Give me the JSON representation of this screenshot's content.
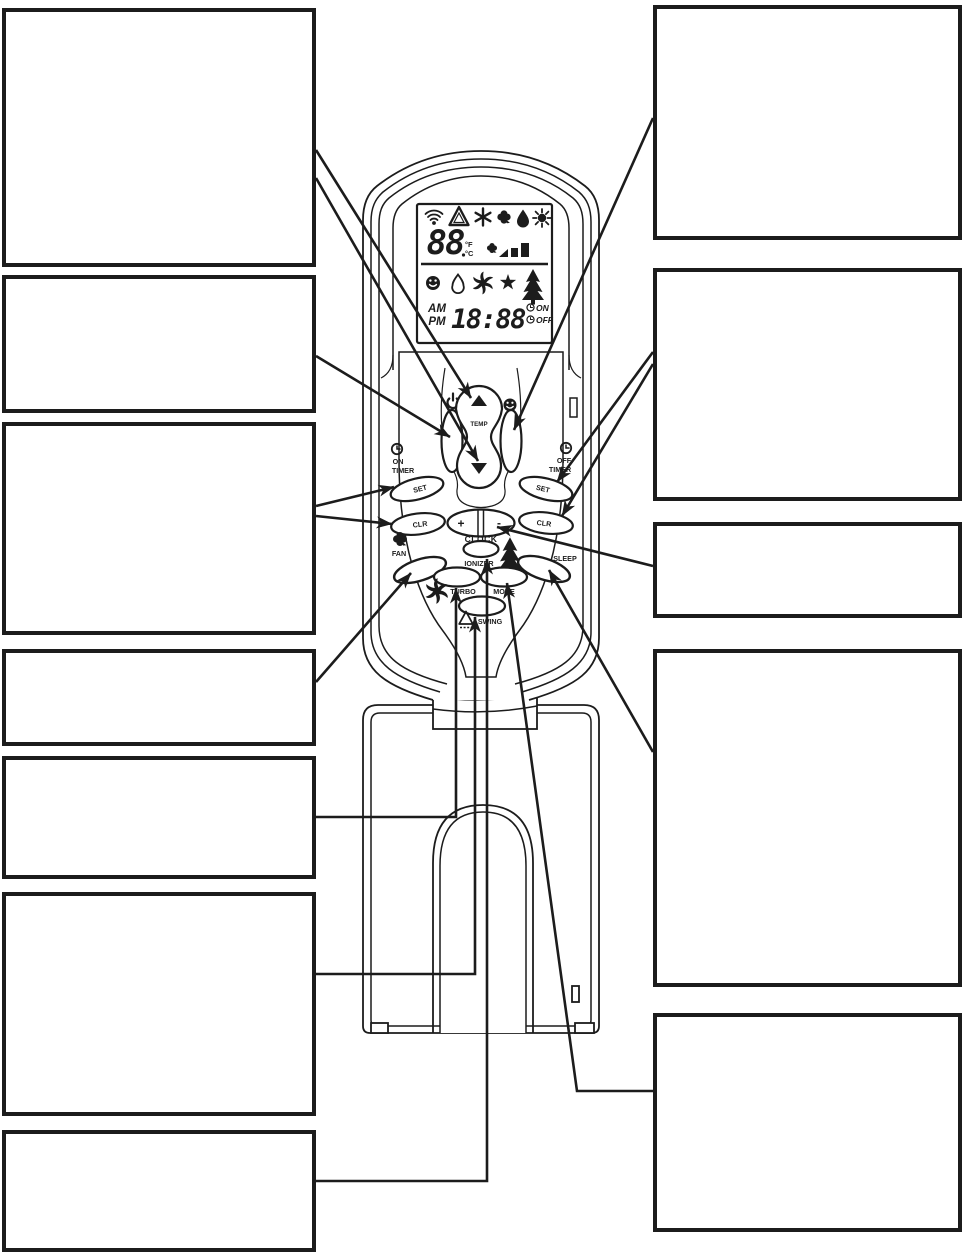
{
  "page": {
    "title": "Air-conditioner remote control callout diagram"
  },
  "remote": {
    "display": {
      "temperature": "88",
      "unit_f": "°F",
      "unit_c": "°C",
      "am": "AM",
      "pm": "PM",
      "time": "18:88",
      "timer_on": "ON",
      "timer_off": "OFF",
      "icons_row1": [
        "signal-icon",
        "auto-triangle-icon",
        "cool-snowflake-icon",
        "fan-clover-icon",
        "dry-drop-icon",
        "heat-sun-icon"
      ],
      "fan_speed_icon": "fan-speed-bars-icon",
      "icons_row2": [
        "comfort-smiley-icon",
        "swing-drop-outline-icon",
        "turbo-pinwheel-icon",
        "sleep-star-icon",
        "ionizer-tree-icon"
      ]
    },
    "buttons": {
      "power_icon": "power-icon",
      "comfort_icon": "smiley-icon",
      "temp": "TEMP",
      "on_timer_line1": "ON",
      "on_timer_line2": "TIMER",
      "off_timer_line1": "OFF",
      "off_timer_line2": "TIMER",
      "set_left": "SET",
      "clr_left": "CLR",
      "set_right": "SET",
      "clr_right": "CLR",
      "clock": "CLOCK",
      "clock_plus": "+",
      "clock_minus": "-",
      "fan": "FAN",
      "turbo": "TURBO",
      "ionizer": "IONIZER",
      "mode": "MODE",
      "sleep": "SLEEP",
      "swing": "SWING"
    }
  },
  "callouts": {
    "left": [
      "",
      "",
      "",
      "",
      "",
      "",
      ""
    ],
    "right": [
      "",
      "",
      "",
      "",
      ""
    ]
  },
  "colors": {
    "ink": "#1c1c1c",
    "paper": "#ffffff"
  }
}
